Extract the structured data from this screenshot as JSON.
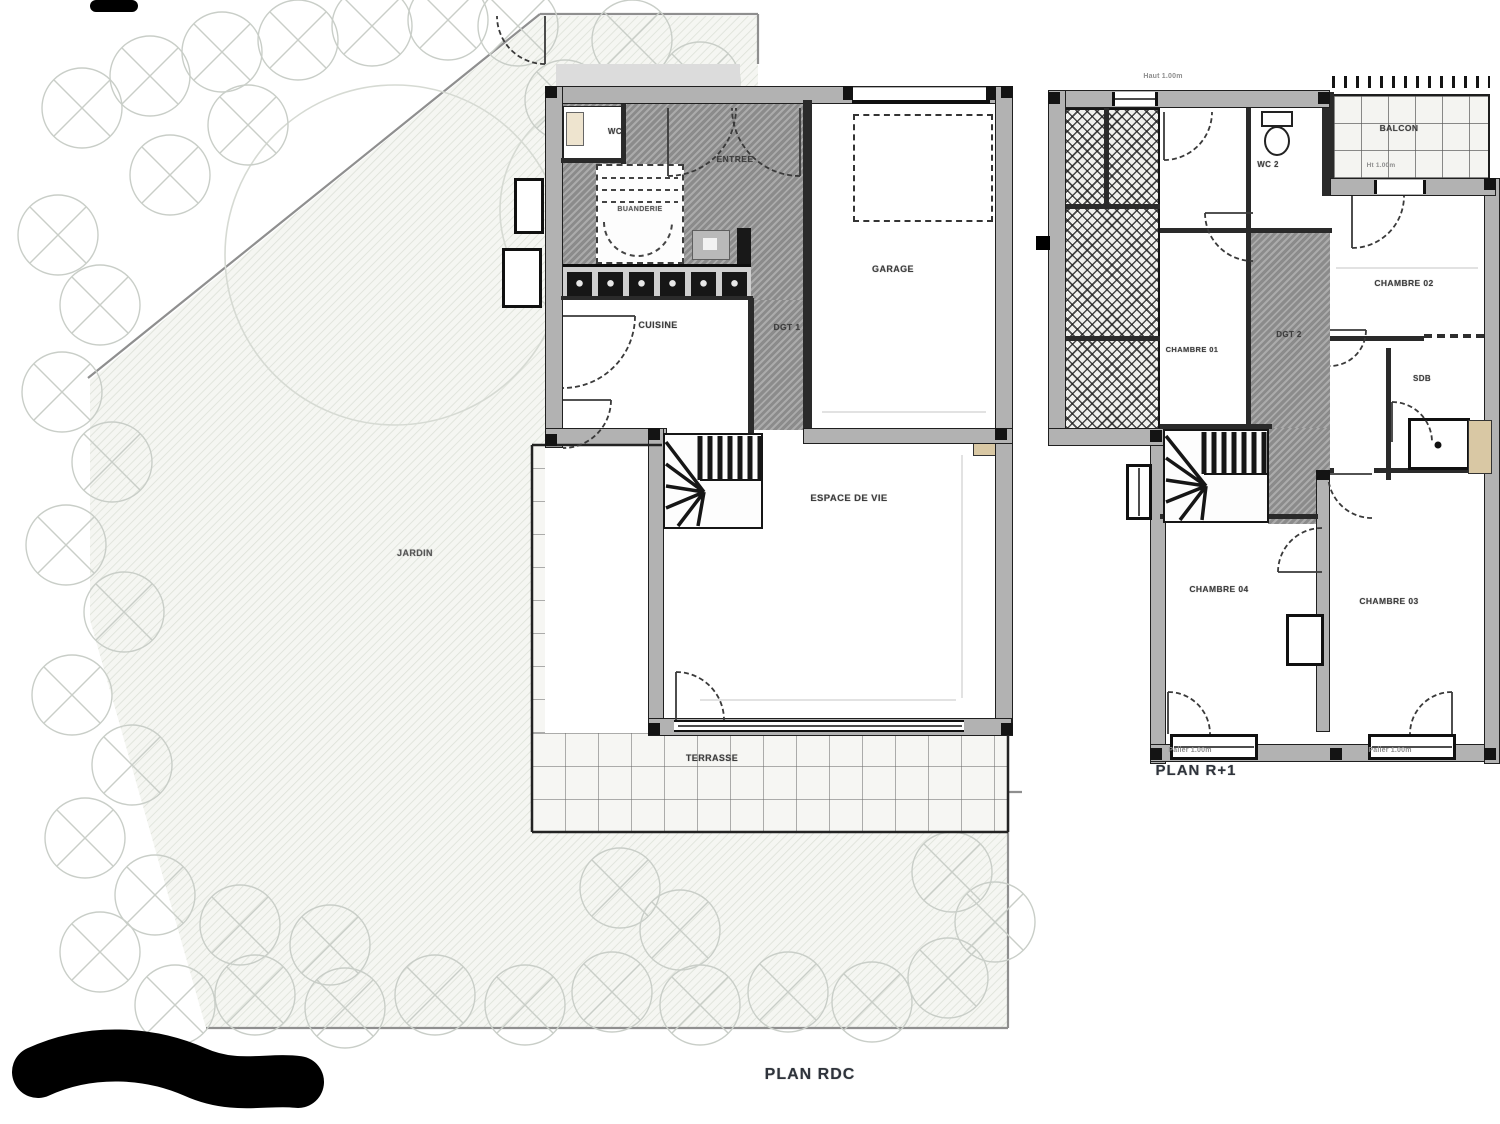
{
  "drawing": {
    "rdc": {
      "title": "PLAN RDC",
      "rooms": {
        "jardin": "JARDIN",
        "terrasse": "TERRASSE",
        "wc": "WC",
        "entree": "ENTREE",
        "buanderie": "BUANDERIE",
        "cuisine": "CUISINE",
        "dgt1": "DGT 1",
        "garage": "GARAGE",
        "espace_de_vie": "ESPACE DE VIE"
      }
    },
    "r1": {
      "title": "PLAN R+1",
      "rooms": {
        "wc2": "WC 2",
        "balcon": "BALCON",
        "chambre01": "CHAMBRE 01",
        "chambre02": "CHAMBRE 02",
        "chambre03": "CHAMBRE 03",
        "chambre04": "CHAMBRE 04",
        "dgt2": "DGT 2",
        "sdb": "SDB"
      },
      "annotations": {
        "top_window": "Haut 1.00m",
        "balcon_height": "Ht 1.00m",
        "sill_left": "Palier 1.00m",
        "sill_right": "Palier 1.00m"
      }
    },
    "colors": {
      "wall_fill": "#b2b2b2",
      "wall_line": "#1f1f1f",
      "circulation_hatch": "#9b9b9b",
      "tree_stroke": "#c9cec8",
      "title_color": "#2e333b"
    }
  }
}
